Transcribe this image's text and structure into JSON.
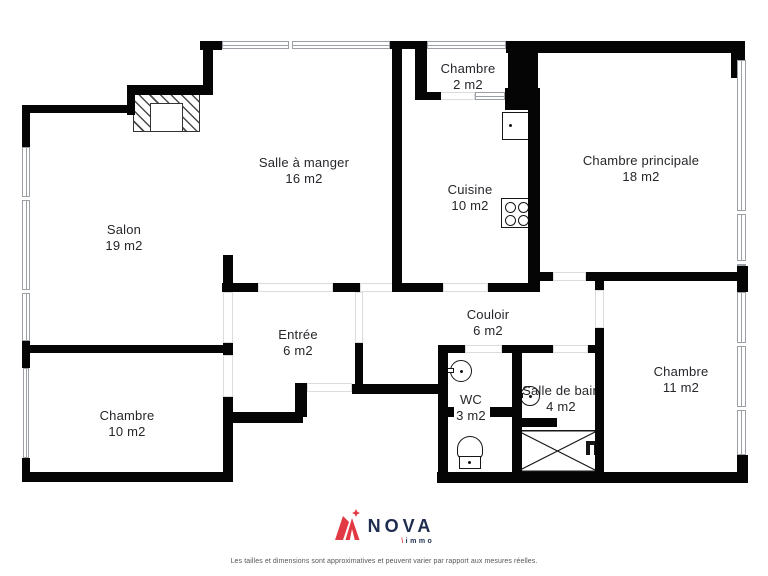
{
  "title": "Floor plan",
  "colors": {
    "wall": "#050505",
    "window_border": "#9aa0a6",
    "opening_border": "#dcdcdc",
    "label": "#26262b",
    "brand_navy": "#1e2d4f",
    "brand_red": "#e23a44"
  },
  "rooms": [
    {
      "id": "salle-a-manger",
      "name": "Salle à manger",
      "area": "16 m2",
      "cx": 304,
      "cy": 171
    },
    {
      "id": "salon",
      "name": "Salon",
      "area": "19 m2",
      "cx": 124,
      "cy": 238
    },
    {
      "id": "chambre-2",
      "name": "Chambre",
      "area": "2 m2",
      "cx": 468,
      "cy": 77
    },
    {
      "id": "cuisine",
      "name": "Cuisine",
      "area": "10 m2",
      "cx": 470,
      "cy": 198
    },
    {
      "id": "chambre-principale",
      "name": "Chambre principale",
      "area": "18 m2",
      "cx": 641,
      "cy": 169
    },
    {
      "id": "entree",
      "name": "Entrée",
      "area": "6 m2",
      "cx": 298,
      "cy": 343
    },
    {
      "id": "couloir",
      "name": "Couloir",
      "area": "6 m2",
      "cx": 488,
      "cy": 323
    },
    {
      "id": "chambre-10",
      "name": "Chambre",
      "area": "10 m2",
      "cx": 127,
      "cy": 424
    },
    {
      "id": "wc",
      "name": "WC",
      "area": "3 m2",
      "cx": 471,
      "cy": 408
    },
    {
      "id": "salle-de-bain",
      "name": "Salle de bain",
      "area": "4 m2",
      "cx": 561,
      "cy": 399
    },
    {
      "id": "chambre-11",
      "name": "Chambre",
      "area": "11 m2",
      "cx": 681,
      "cy": 380
    }
  ],
  "floorplan": {
    "walls": [
      [
        200,
        41,
        22,
        9
      ],
      [
        203,
        41,
        10,
        54
      ],
      [
        127,
        85,
        78,
        10
      ],
      [
        127,
        93,
        8,
        22
      ],
      [
        22,
        105,
        111,
        8
      ],
      [
        22,
        105,
        8,
        44
      ],
      [
        22,
        341,
        8,
        27
      ],
      [
        22,
        345,
        211,
        8
      ],
      [
        390,
        41,
        37,
        8
      ],
      [
        415,
        48,
        12,
        46
      ],
      [
        392,
        48,
        10,
        244
      ],
      [
        415,
        92,
        26,
        8
      ],
      [
        505,
        88,
        35,
        22
      ],
      [
        506,
        41,
        239,
        12
      ],
      [
        508,
        41,
        30,
        69
      ],
      [
        528,
        108,
        12,
        175
      ],
      [
        488,
        283,
        52,
        9
      ],
      [
        400,
        283,
        43,
        9
      ],
      [
        731,
        41,
        14,
        37
      ],
      [
        737,
        266,
        11,
        26
      ],
      [
        737,
        455,
        11,
        28
      ],
      [
        437,
        472,
        311,
        11
      ],
      [
        22,
        472,
        211,
        10
      ],
      [
        22,
        458,
        8,
        16
      ],
      [
        223,
        255,
        10,
        37
      ],
      [
        223,
        343,
        10,
        12
      ],
      [
        223,
        397,
        10,
        85
      ],
      [
        223,
        412,
        80,
        11
      ],
      [
        222,
        283,
        36,
        9
      ],
      [
        333,
        283,
        27,
        9
      ],
      [
        355,
        343,
        8,
        45
      ],
      [
        352,
        384,
        86,
        10
      ],
      [
        295,
        383,
        12,
        34
      ],
      [
        438,
        345,
        10,
        128
      ],
      [
        438,
        345,
        27,
        8
      ],
      [
        502,
        345,
        51,
        8
      ],
      [
        588,
        345,
        16,
        8
      ],
      [
        512,
        353,
        10,
        120
      ],
      [
        448,
        407,
        6,
        10
      ],
      [
        490,
        407,
        22,
        10
      ],
      [
        515,
        418,
        42,
        9
      ],
      [
        595,
        328,
        9,
        145
      ],
      [
        595,
        273,
        9,
        17
      ],
      [
        540,
        272,
        13,
        9
      ],
      [
        586,
        272,
        151,
        9
      ]
    ],
    "windows": [
      {
        "o": "h",
        "x": 222,
        "y": 41,
        "w": 168,
        "h": 8,
        "mullions": [
          288
        ]
      },
      {
        "o": "h",
        "x": 427,
        "y": 41,
        "w": 79,
        "h": 8,
        "mullions": []
      },
      {
        "o": "h",
        "x": 475,
        "y": 92,
        "w": 30,
        "h": 8,
        "mullions": []
      },
      {
        "o": "v",
        "x": 737,
        "y": 60,
        "w": 9,
        "h": 206,
        "mullions": [
          210,
          260
        ]
      },
      {
        "o": "v",
        "x": 737,
        "y": 292,
        "w": 9,
        "h": 163,
        "mullions": [
          342,
          406
        ]
      },
      {
        "o": "v",
        "x": 22,
        "y": 147,
        "w": 8,
        "h": 194,
        "mullions": [
          196,
          289
        ]
      },
      {
        "o": "v",
        "x": 23,
        "y": 368,
        "w": 6,
        "h": 90,
        "mullions": []
      }
    ],
    "openings": [
      {
        "id": "chambre2-door",
        "x": 440,
        "y": 92,
        "w": 35,
        "h": 8
      },
      {
        "id": "cuisine-door",
        "x": 443,
        "y": 283,
        "w": 45,
        "h": 9
      },
      {
        "id": "chambre-principale-door",
        "x": 553,
        "y": 272,
        "w": 33,
        "h": 9
      },
      {
        "id": "chambre11-door",
        "x": 595,
        "y": 290,
        "w": 9,
        "h": 38
      },
      {
        "id": "wc-door",
        "x": 465,
        "y": 345,
        "w": 37,
        "h": 8
      },
      {
        "id": "salle-de-bain-door",
        "x": 553,
        "y": 345,
        "w": 35,
        "h": 8
      },
      {
        "id": "chambre10-door",
        "x": 223,
        "y": 355,
        "w": 10,
        "h": 42
      },
      {
        "id": "salon-entree-opening",
        "x": 223,
        "y": 292,
        "w": 10,
        "h": 51
      },
      {
        "id": "entree-couloir-opening",
        "x": 355,
        "y": 292,
        "w": 8,
        "h": 51
      },
      {
        "id": "entree-sam-opening",
        "x": 258,
        "y": 283,
        "w": 75,
        "h": 9
      },
      {
        "id": "entree-sam-opening-2",
        "x": 360,
        "y": 283,
        "w": 33,
        "h": 9
      },
      {
        "id": "front-door",
        "x": 307,
        "y": 383,
        "w": 45,
        "h": 9
      }
    ],
    "fireplace": {
      "hatch": [
        133,
        90,
        67,
        42
      ],
      "flue": [
        150,
        103,
        33,
        29
      ]
    }
  },
  "branding": {
    "logo_name": "NOVA",
    "logo_sub": "immo",
    "logo_sub_slash": "\\"
  },
  "disclaimer": "Les tailles et dimensions sont approximatives et peuvent varier par rapport aux mesures réelles."
}
